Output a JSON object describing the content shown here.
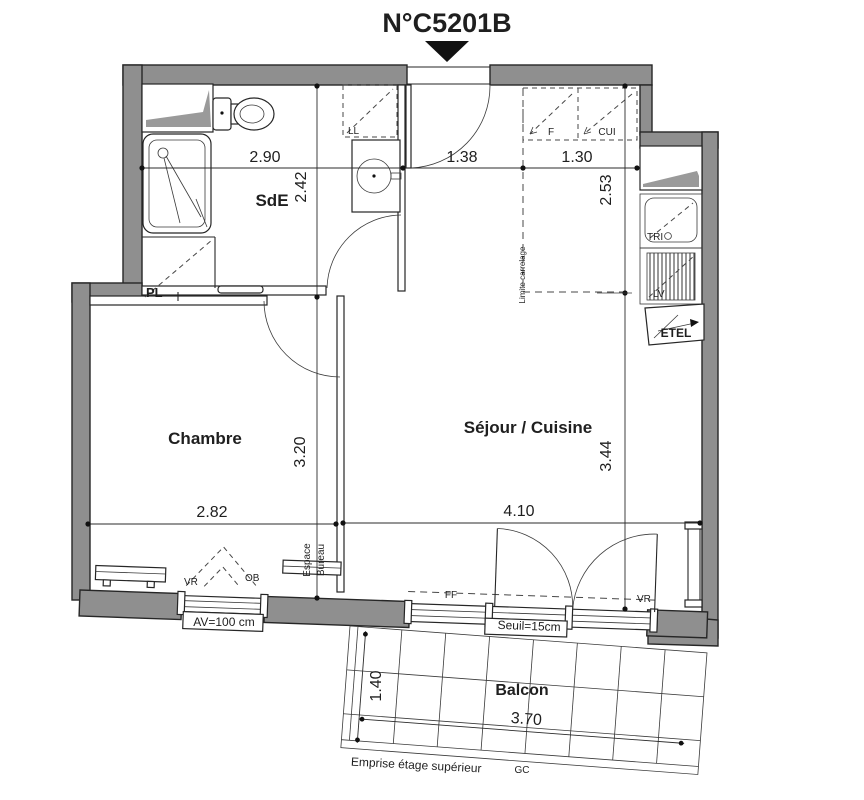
{
  "title": "N°C5201B",
  "rooms": {
    "bathroom": "SdE",
    "bedroom": "Chambre",
    "living": "Séjour / Cuisine",
    "balcony": "Balcon"
  },
  "fixtures": {
    "washing_machine": "LL",
    "fridge": "F",
    "kitchen_unit": "CUI",
    "closet": "PL",
    "sorting_bin": "TRI",
    "dishwasher": "LV",
    "electrical_box": "ETEL",
    "shutter_bedroom": "VR",
    "shutter_living": "VR",
    "tilt_window": "OB",
    "fixed_pane": "FF"
  },
  "annotations": {
    "desk_line1": "Espace",
    "desk_line2": "Bureau",
    "tile_limit": "Limite carrelage",
    "sill_height": "AV=100 cm",
    "threshold": "Seuil=15cm",
    "upper_floor": "Emprise étage supérieur",
    "gc": "GC"
  },
  "dimensions": {
    "bathroom_width": "2.90",
    "bathroom_depth": "2.42",
    "entry_width": "1.38",
    "kitchen_width": "1.30",
    "kitchen_depth": "2.53",
    "bedroom_depth": "3.20",
    "bedroom_width": "2.82",
    "living_width": "4.10",
    "living_depth": "3.44",
    "balcony_depth": "1.40",
    "balcony_width": "3.70"
  },
  "colors": {
    "wall_fill": "#8f8f8f",
    "line": "#262626",
    "text": "#1f1f1f"
  }
}
